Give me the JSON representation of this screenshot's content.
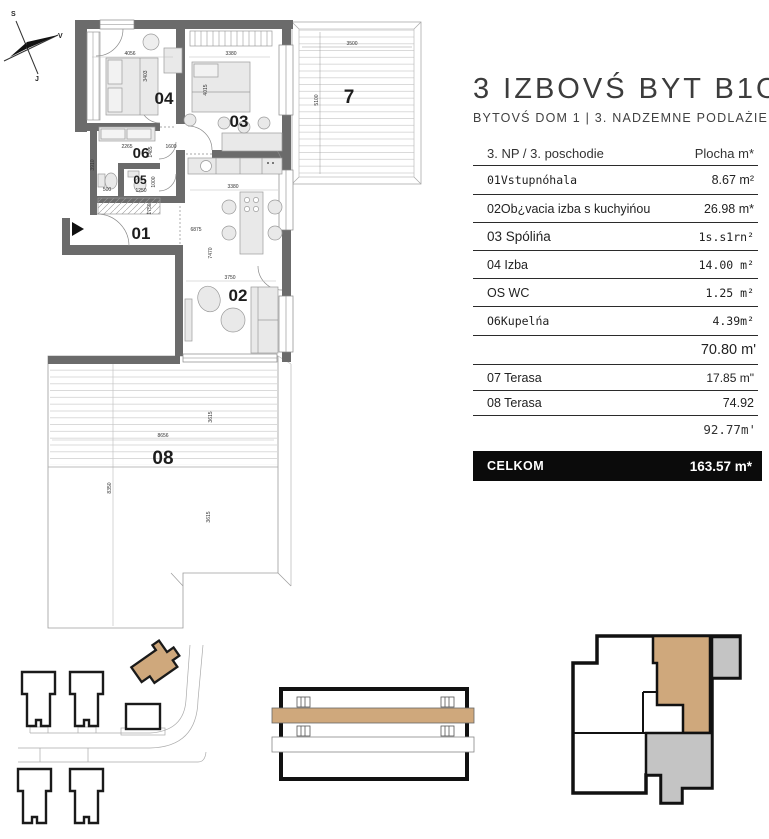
{
  "panel": {
    "title": "3 IZBOVŚ BYT B1O",
    "subtitle": "BYTOVŚ DOM 1 | 3. NADZEMNE PODLAŻIE",
    "table": {
      "header": {
        "left": "3. NP / 3. poschodie",
        "right": "Plocha m*"
      },
      "rows": [
        {
          "label": "01Vstupnóhala",
          "value": "8.67 m²"
        },
        {
          "label": "02Ob¿vacia izba s kuchyińou",
          "value": "26.98 m*"
        },
        {
          "label": "03 Spólińa",
          "value": "1s.s1rn²"
        },
        {
          "label": "04  Izba",
          "value": "14.00 m²"
        },
        {
          "label": "OS WC",
          "value": "1.25 m²"
        },
        {
          "label": "O6Kupelńa",
          "value": "4.39m²"
        },
        {
          "label": "07 Terasa",
          "value": "17.85 m\""
        },
        {
          "label": "08 Terasa",
          "value": "74.92"
        }
      ],
      "subtotal1": "70.80 m'",
      "subtotal2": "92.77m'",
      "total_label": "CELKOM",
      "total_value": "163.57 m*"
    }
  },
  "plan": {
    "compass": {
      "n": "S",
      "e": "V",
      "s": "J"
    },
    "labels": {
      "r01": "01",
      "r02": "02",
      "r03": "03",
      "r04": "04",
      "r05": "05",
      "r06": "06",
      "r07": "7",
      "r08": "08"
    },
    "dims": {
      "room04_w": "4056",
      "room04_h": "3403",
      "room03_w": "3380",
      "room03_h": "4015",
      "terr7_w": "3500",
      "terr7_h": "5100",
      "room06_a": "2265",
      "room06_b": "1485",
      "room06_c": "1600",
      "hall_h": "3910",
      "room05_a": "500",
      "room05_b": "1250",
      "room05_c": "1000",
      "hall_d": "1750",
      "living_w": "6875",
      "living_h": "7470",
      "kitchen_w": "3380",
      "living_w2": "3750",
      "terr8_w": "8656",
      "terr8_h1": "3615",
      "terr8_h2": "8350",
      "terr8_h3": "3615"
    },
    "colors": {
      "wall": "#6b6b6b",
      "highlight": "#cfa87c",
      "unit_gray": "#c4c4c4"
    }
  }
}
